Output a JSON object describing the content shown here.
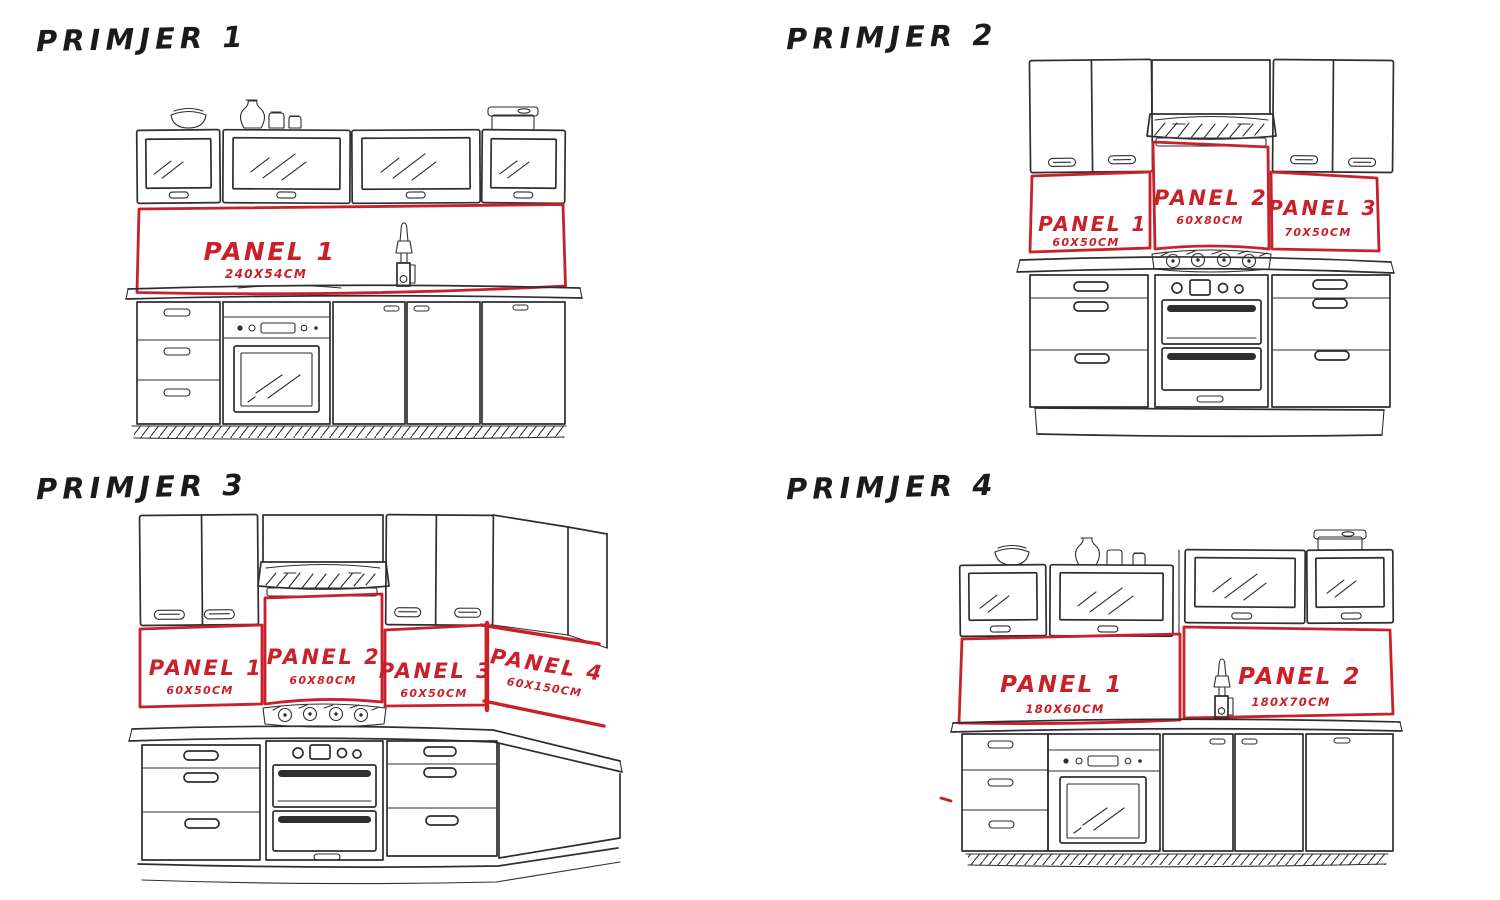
{
  "page": {
    "background": "#ffffff",
    "ink_color": "#2e2e2e",
    "accent_red": "#c9202a",
    "description": "Hand-drawn kitchen backsplash panel layout examples"
  },
  "examples": [
    {
      "title": "PRIMJER 1",
      "panels": [
        {
          "label": "PANEL 1",
          "size": "240X54CM"
        }
      ]
    },
    {
      "title": "PRIMJER 2",
      "panels": [
        {
          "label": "PANEL 1",
          "size": "60X50CM"
        },
        {
          "label": "PANEL 2",
          "size": "60X80CM"
        },
        {
          "label": "PANEL 3",
          "size": "70X50CM"
        }
      ]
    },
    {
      "title": "PRIMJER 3",
      "panels": [
        {
          "label": "PANEL 1",
          "size": "60X50CM"
        },
        {
          "label": "PANEL 2",
          "size": "60X80CM"
        },
        {
          "label": "PANEL 3",
          "size": "60X50CM"
        },
        {
          "label": "PANEL 4",
          "size": "60X150CM"
        }
      ]
    },
    {
      "title": "PRIMJER 4",
      "panels": [
        {
          "label": "PANEL 1",
          "size": "180X60CM"
        },
        {
          "label": "PANEL 2",
          "size": "180X70CM"
        }
      ]
    }
  ]
}
